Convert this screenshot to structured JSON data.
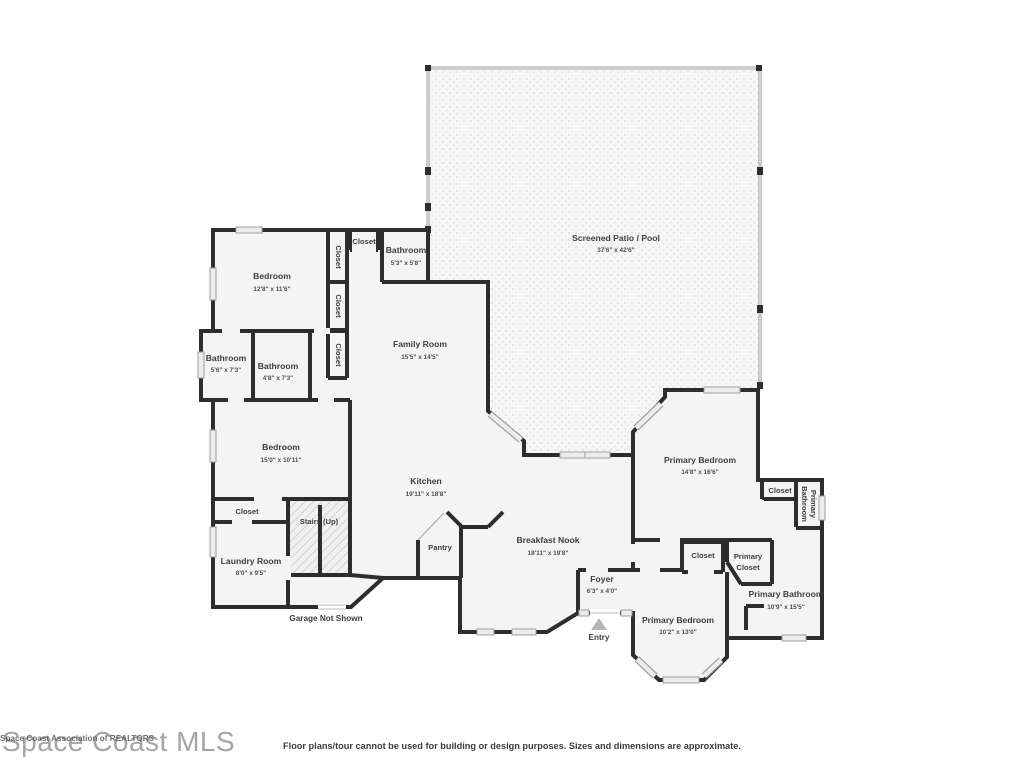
{
  "colors": {
    "wall": "#2d2d2d",
    "floor": "#f4f4f4",
    "window": "#ededed",
    "screen": "#9b9b9b"
  },
  "watermark": {
    "primary": "Space Coast MLS",
    "overlay": "Space Coast Association of REALTORS"
  },
  "disclaimer": "Floor plans/tour cannot be used for building or design purposes. Sizes and dimensions are approximate.",
  "notes": {
    "garage": "Garage Not Shown",
    "entry": "Entry"
  },
  "rooms": {
    "patio": {
      "name": "Screened Patio / Pool",
      "dims": "37'6\" x 42'6\""
    },
    "bedroom1": {
      "name": "Bedroom",
      "dims": "12'8\" x 11'6\""
    },
    "closet_top": {
      "name": "Closet"
    },
    "bathroom_top": {
      "name": "Bathroom",
      "dims": "5'3\" x 5'8\""
    },
    "closet_v1": {
      "name": "Closet"
    },
    "closet_v2": {
      "name": "Closet"
    },
    "closet_v3": {
      "name": "Closet"
    },
    "family_room": {
      "name": "Family Room",
      "dims": "15'5\" x 14'5\""
    },
    "bathroom_left": {
      "name": "Bathroom",
      "dims": "5'6\" x 7'3\""
    },
    "bathroom_mid": {
      "name": "Bathroom",
      "dims": "4'8\" x 7'3\""
    },
    "bedroom2": {
      "name": "Bedroom",
      "dims": "15'0\" x 10'11\""
    },
    "closet_bed2": {
      "name": "Closet"
    },
    "stairs": {
      "name": "Stairs (Up)"
    },
    "laundry": {
      "name": "Laundry Room",
      "dims": "8'0\" x 9'5\""
    },
    "kitchen": {
      "name": "Kitchen",
      "dims": "19'11\" x 18'8\""
    },
    "pantry": {
      "name": "Pantry"
    },
    "breakfast_nook": {
      "name": "Breakfast Nook",
      "dims": "18'11\" x 19'8\""
    },
    "foyer": {
      "name": "Foyer",
      "dims": "6'3\" x 4'0\""
    },
    "primary_bedroom1": {
      "name": "Primary Bedroom",
      "dims": "14'8\" x 16'6\""
    },
    "closet_pb": {
      "name": "Closet"
    },
    "primary_bathroom_small": {
      "line1": "Primary",
      "line2": "Bathroom"
    },
    "closet_foyer": {
      "name": "Closet"
    },
    "primary_closet": {
      "line1": "Primary",
      "line2": "Closet"
    },
    "primary_bathroom": {
      "name": "Primary Bathroom",
      "dims": "10'9\" x 15'5\""
    },
    "primary_bedroom2": {
      "name": "Primary Bedroom",
      "dims": "10'2\" x 13'0\""
    }
  }
}
